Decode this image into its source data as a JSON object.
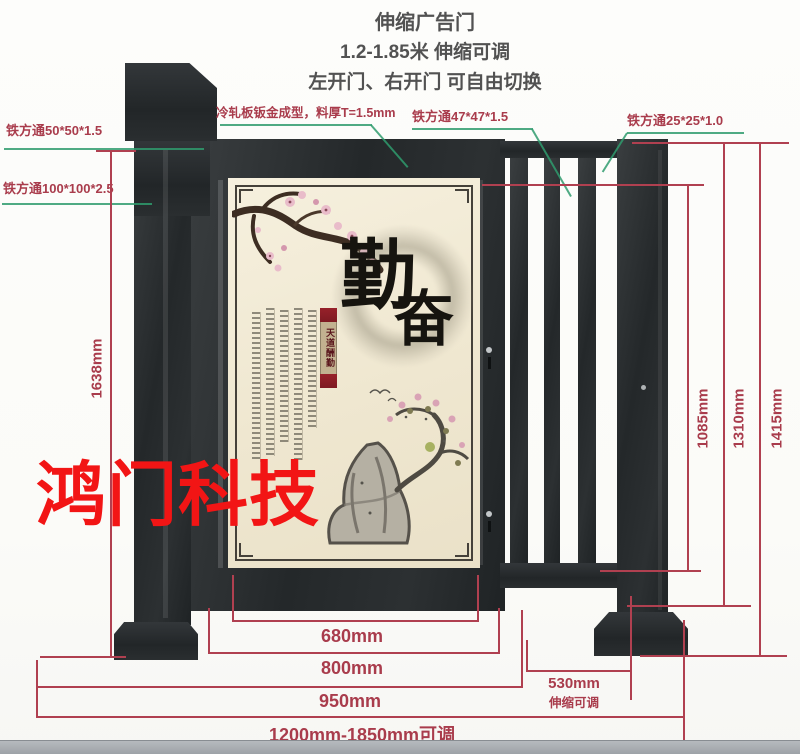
{
  "header": {
    "title": "伸缩广告门",
    "subtitle": "1.2-1.85米 伸缩可调",
    "note": "左开门、右开门 可自由切换"
  },
  "callouts": {
    "tube_50": "铁方通50*50*1.5",
    "tube_100": "铁方通100*100*2.5",
    "cold_rolled_panel": "冷轧板钣金成型，料厚T=1.5mm",
    "tube_47": "铁方通47*47*1.5",
    "tube_25": "铁方通25*25*1.0"
  },
  "dims": {
    "leaf_height": "1638mm",
    "infill_height": "1085mm",
    "frame_height": "1310mm",
    "post_height": "1415mm",
    "panel_width": "680mm",
    "leaf_width": "800mm",
    "leaf_post_width": "950mm",
    "telescopic_width": "530mm",
    "telescopic_note": "伸缩可调",
    "overall_range": "1200mm-1850mm可调"
  },
  "poster": {
    "calligraphy_top": "勤",
    "calligraphy_bottom": "奋",
    "ribbon_text": "天道酬勤"
  },
  "watermark": {
    "text": "鸿门科技"
  },
  "colors": {
    "dimension_red": "#b04050",
    "leader_green": "#2f9b6d",
    "gate_dark": "#2b2f31",
    "poster_cream": "#f1e9d6",
    "watermark_red": "#f21515"
  }
}
